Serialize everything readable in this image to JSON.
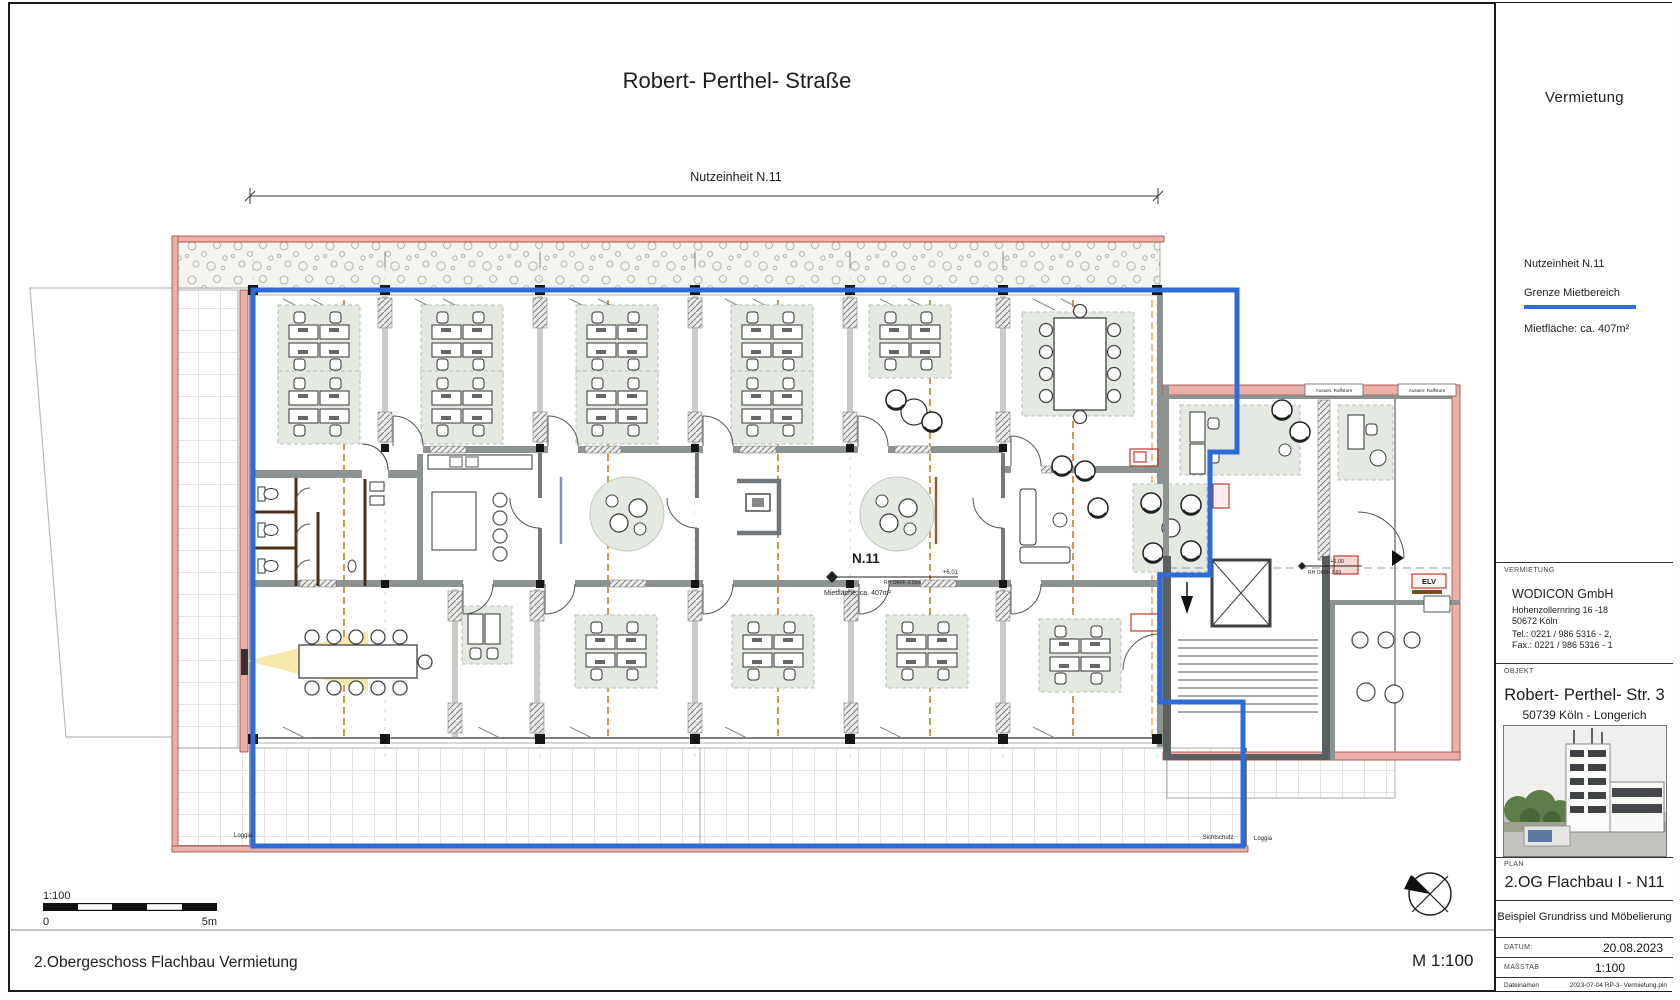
{
  "sheet": {
    "title": "Robert- Perthel- Straße",
    "caption": "2.Obergeschoss Flachbau Vermietung",
    "scale_note": "M 1:100"
  },
  "plan": {
    "dimension_label": "Nutzeinheit  N.11",
    "unit_label": "N.11",
    "elevation": "+6,01",
    "elevation_sub": "RH OKFF 3,16m",
    "area_note": "Mietfläche:  ca. 407m²",
    "stair_elevation": "+6,00",
    "stair_elevation_sub": "RH OKFF 2,69",
    "elv_label": "ELV",
    "loggia_left": "Loggia",
    "sichtschutz": "Sichtschutz",
    "loggia_right": "Loggia",
    "raffstore_1": "Aussen. Raffstore",
    "raffstore_2": "Aussen. Raffstore"
  },
  "scalebar": {
    "ratio": "1:100",
    "start": "0",
    "end": "5m"
  },
  "titleblock": {
    "header": "Vermietung",
    "legend": {
      "unit": "Nutzeinheit  N.11",
      "boundary": "Grenze Mietbereich",
      "area": "Mietfläche:  ca. 407m²"
    },
    "vermietung": {
      "label": "VERMIETUNG",
      "company": "WODICON GmbH",
      "street": "Hohenzollernring 16 -18",
      "city": "50672 Köln",
      "tel": "Tel.: 0221 / 986 5316 - 2,",
      "fax": "Fax.: 0221 / 986 5316 - 1"
    },
    "objekt": {
      "label": "OBJEKT",
      "name": "Robert- Perthel- Str. 3",
      "city": "50739 Köln - Longerich"
    },
    "plan": {
      "label": "PLAN",
      "name": "2.OG Flachbau I - N11",
      "subtitle": "Beispiel Grundriss und Möbelierung"
    },
    "meta": {
      "date_label": "DATUM:",
      "date": "20.08.2023",
      "scale_label": "MAßSTAB",
      "scale": "1:100",
      "file_label": "Dateinamen",
      "file": "2023-07-04 RP-3- Vermietung.pln"
    }
  },
  "colors": {
    "boundary_blue": "#2e6bd8",
    "wall_pink": "#eab1ab",
    "wall_red": "#a3463d",
    "carpet": "#e4e9e2",
    "wood": "#4a3018",
    "beam_orange": "#cf8f2e",
    "accent_red": "#c0392b"
  }
}
